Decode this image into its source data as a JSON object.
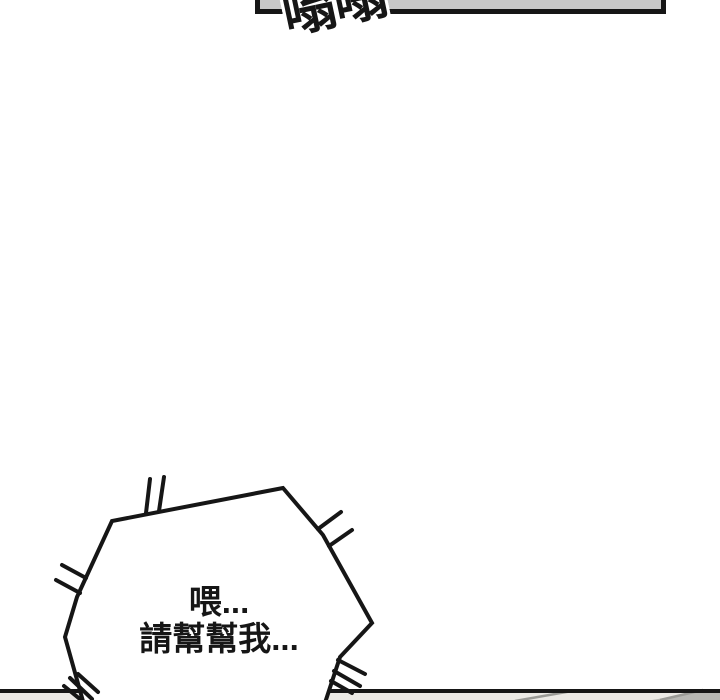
{
  "colors": {
    "bg": "#ffffff",
    "ink": "#161616",
    "panel-gray": "#c8c8c8",
    "strip-gray": "#ebe9e5",
    "strip-shade": "#b7b7b3",
    "strip-line": "#9a9a96"
  },
  "top_panel": {
    "sfx": "嗡嗡"
  },
  "speech_bubble": {
    "line1": "喂...",
    "line2": "請幫幫我..."
  }
}
